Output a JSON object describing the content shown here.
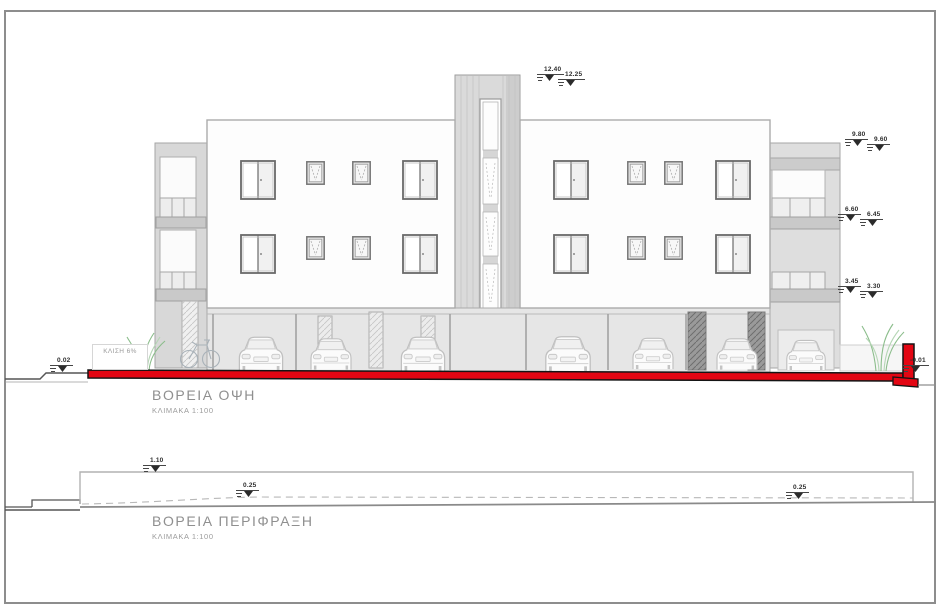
{
  "main_view": {
    "title": "ΒΟΡΕΙΑ ΟΨΗ",
    "scale": "ΚΛΙΜΑΚΑ 1:100",
    "slope_label": "ΚΛΙΣΗ 6%",
    "levels": {
      "tower_a": "12.40",
      "tower_b": "12.25",
      "roof_a": "9.80",
      "roof_b": "9.60",
      "second_a": "6.60",
      "second_b": "6.45",
      "first_a": "3.45",
      "first_b": "3.30",
      "ground_left": "0.02",
      "ground_right": "-0.01"
    },
    "colors": {
      "ground_line_red": "#e30613",
      "line_gray": "#a6a6a6",
      "plant_green": "#8bbd8b"
    }
  },
  "fence_view": {
    "title": "ΒΟΡΕΙΑ ΠΕΡΙΦΡΑΞΗ",
    "scale": "ΚΛΙΜΑΚΑ 1:100",
    "dims": {
      "wall_height": "1.10",
      "offset_mid": "0.25",
      "offset_right": "0.25"
    }
  }
}
